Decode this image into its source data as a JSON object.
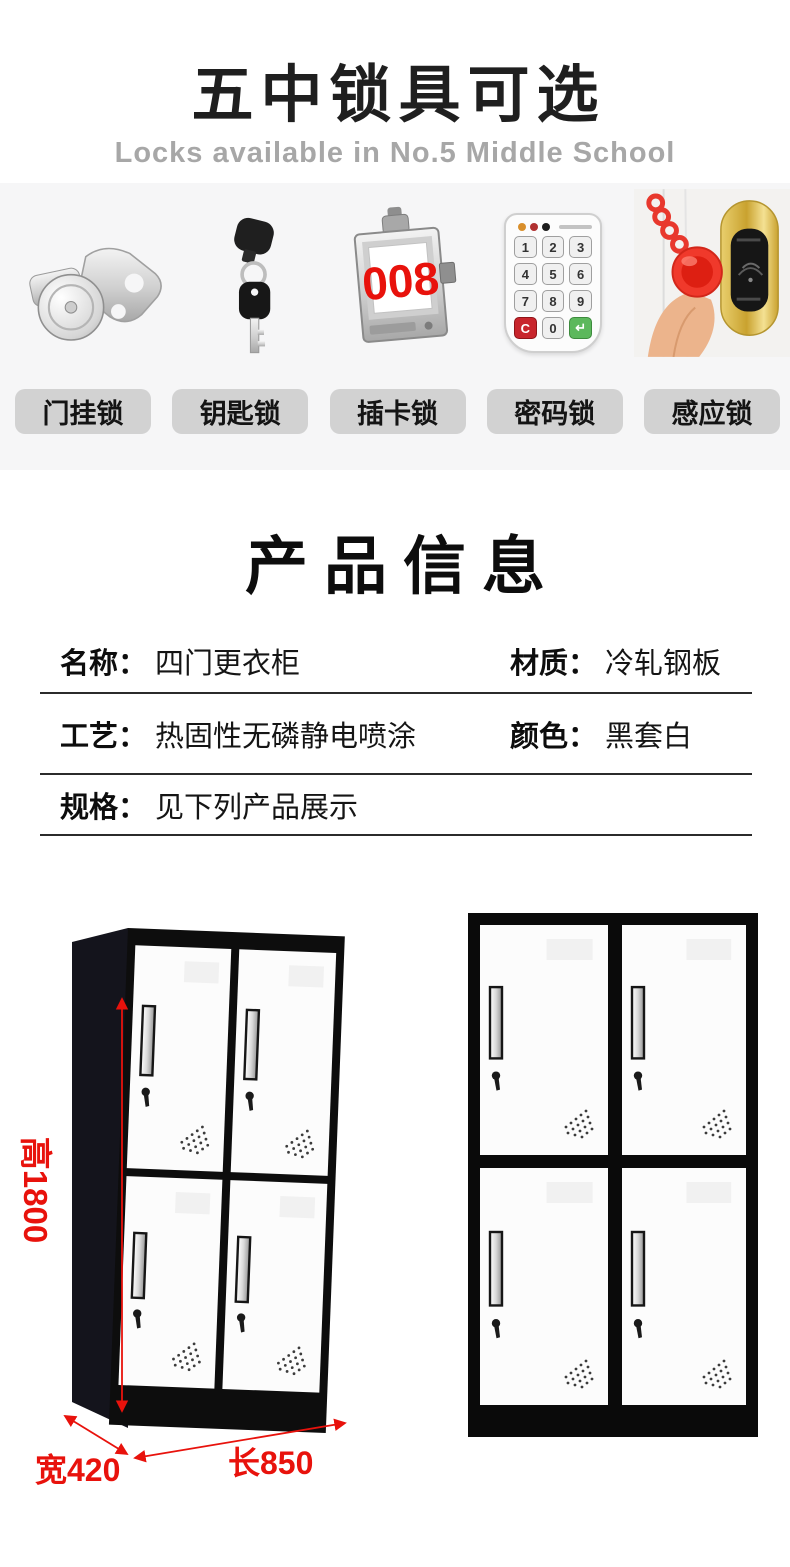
{
  "header": {
    "title": "五中锁具可选",
    "subtitle": "Locks available in No.5 Middle School"
  },
  "locks": {
    "chips": [
      {
        "label": "门挂锁"
      },
      {
        "label": "钥匙锁"
      },
      {
        "label": "插卡锁"
      },
      {
        "label": "密码锁"
      },
      {
        "label": "感应锁"
      }
    ],
    "card_lock_number": "008",
    "keypad_keys": [
      "1",
      "2",
      "3",
      "4",
      "5",
      "6",
      "7",
      "8",
      "9",
      "C",
      "0",
      "↵"
    ]
  },
  "product_info": {
    "title": "产品信息",
    "fields": {
      "name": {
        "label": "名称：",
        "value": "四门更衣柜"
      },
      "material": {
        "label": "材质：",
        "value": "冷轧钢板"
      },
      "process": {
        "label": "工艺：",
        "value": "热固性无磷静电喷涂"
      },
      "color": {
        "label": "颜色：",
        "value": "黑套白"
      },
      "spec": {
        "label": "规格：",
        "value": "见下列产品展示"
      }
    }
  },
  "showcase": {
    "height_label": "高1800",
    "width_label": "宽420",
    "length_label": "长850"
  },
  "colors": {
    "accent_red": "#e8120c",
    "band_bg": "#f6f6f7",
    "chip_bg": "#d2d2d2"
  }
}
